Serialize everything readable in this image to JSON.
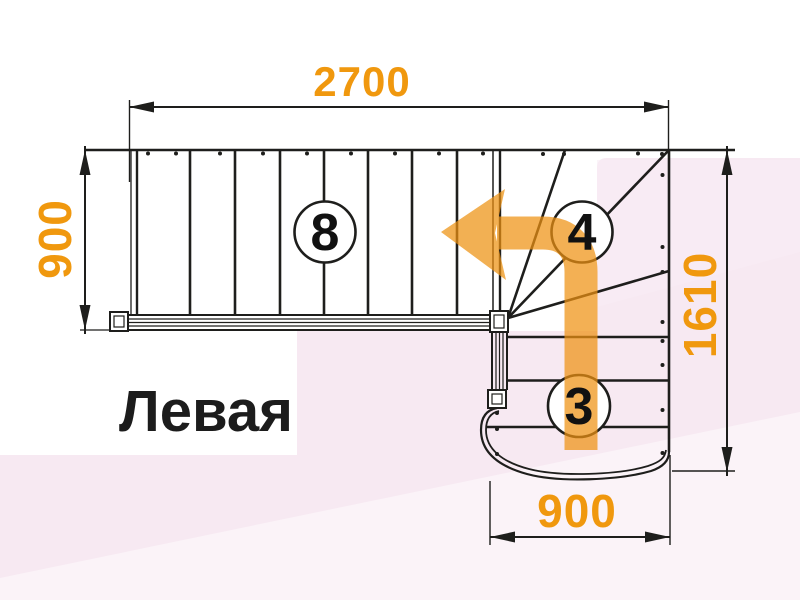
{
  "title": {
    "label": "Левая"
  },
  "plan": {
    "type": "staircase-floor-plan-quarter-turn",
    "dimensions_mm": {
      "top_length": "2700",
      "left_width": "900",
      "right_height": "1610",
      "bottom_width": "900"
    },
    "step_counts": {
      "upper_flight": "8",
      "winders": "4",
      "lower_flight": "3"
    }
  },
  "colors": {
    "accent_orange": "#F0980E",
    "arrow_orange": "#EE9212",
    "line_black": "#1E1E1C",
    "bg_pink": "#F7E9F2",
    "bg_pink_light": "#FBF3F8"
  }
}
